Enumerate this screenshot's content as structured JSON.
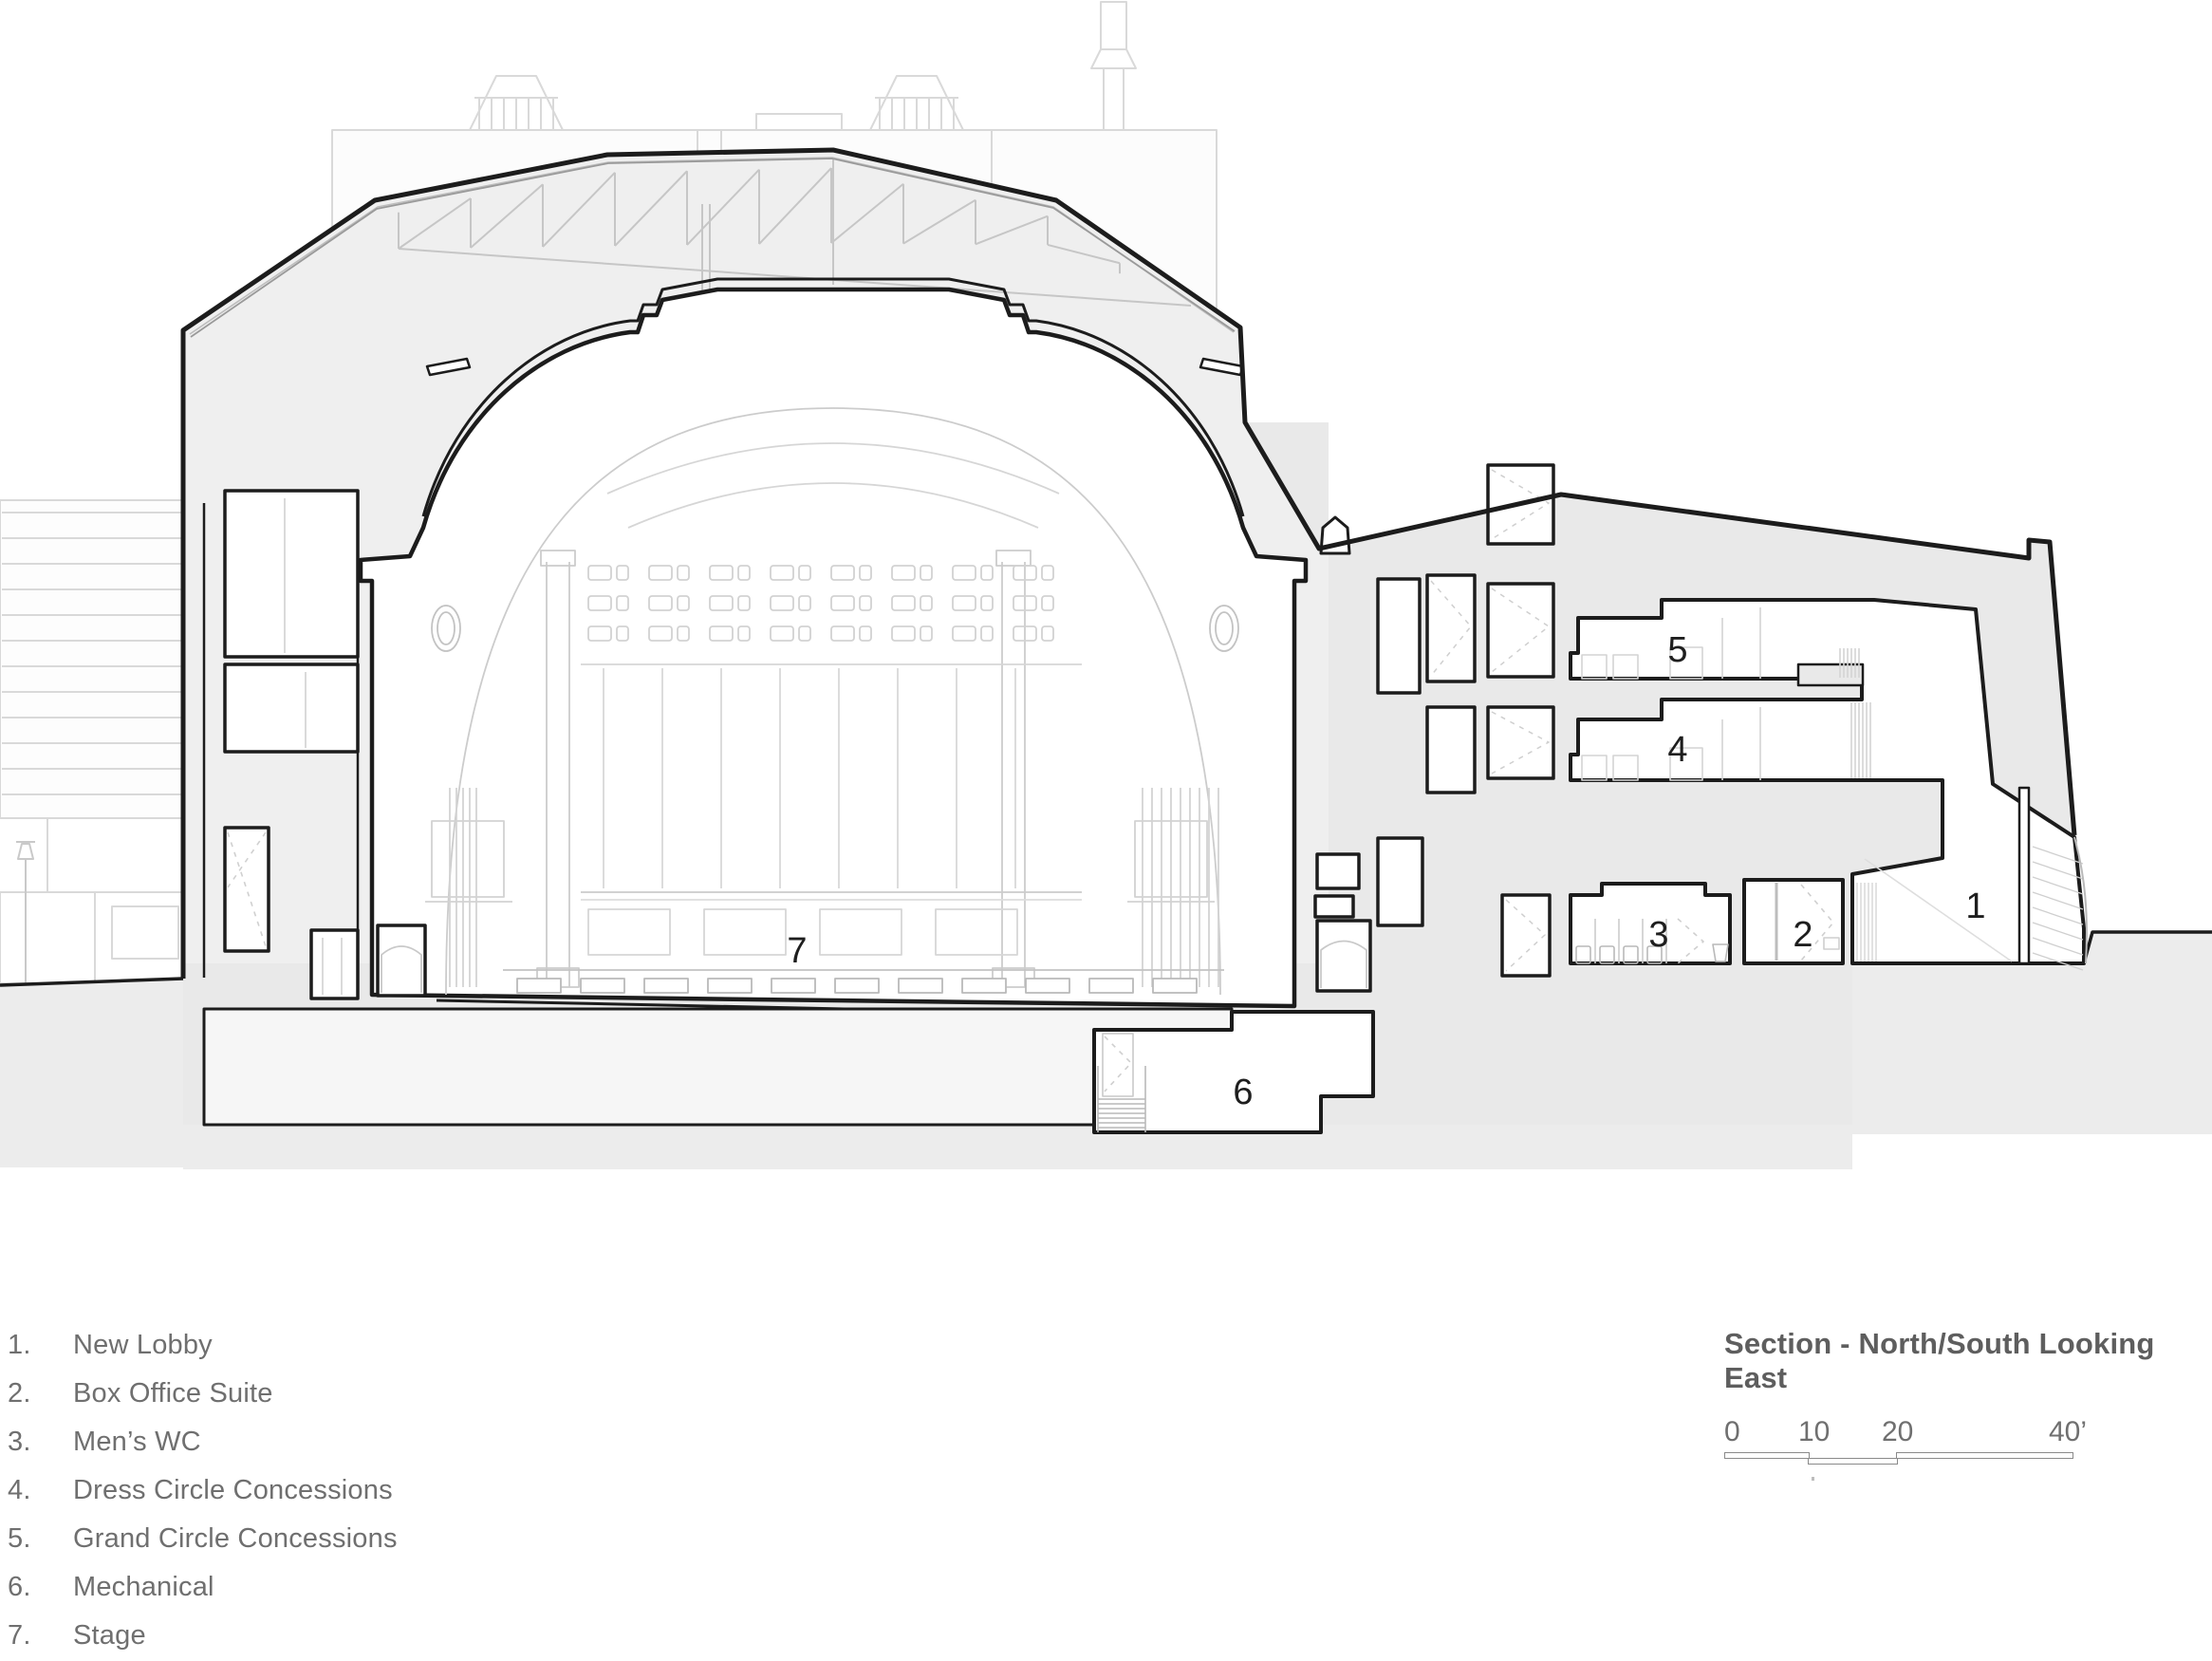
{
  "view": {
    "title": "Section - North/South Looking East"
  },
  "scale_bar": {
    "ticks": [
      "0",
      "10",
      "20",
      "40’"
    ]
  },
  "legend": [
    {
      "num": "1.",
      "label": "New Lobby"
    },
    {
      "num": "2.",
      "label": "Box Office Suite"
    },
    {
      "num": "3.",
      "label": "Men’s WC"
    },
    {
      "num": "4.",
      "label": "Dress Circle Concessions"
    },
    {
      "num": "5.",
      "label": "Grand Circle Concessions"
    },
    {
      "num": "6.",
      "label": "Mechanical"
    },
    {
      "num": "7.",
      "label": "Stage"
    }
  ],
  "rooms": [
    {
      "num": "1",
      "name": "New Lobby"
    },
    {
      "num": "2",
      "name": "Box Office Suite"
    },
    {
      "num": "3",
      "name": "Men’s WC"
    },
    {
      "num": "4",
      "name": "Dress Circle Concessions"
    },
    {
      "num": "5",
      "name": "Grand Circle Concessions"
    },
    {
      "num": "6",
      "name": "Mechanical"
    },
    {
      "num": "7",
      "name": "Stage"
    }
  ],
  "colors": {
    "cut_line": "#1c1c1c",
    "poche": "#e9e9e9",
    "attic": "#efefef",
    "light_line": "#c9c9c9",
    "background_line": "#d9d9d9",
    "ground": "#ececec"
  }
}
